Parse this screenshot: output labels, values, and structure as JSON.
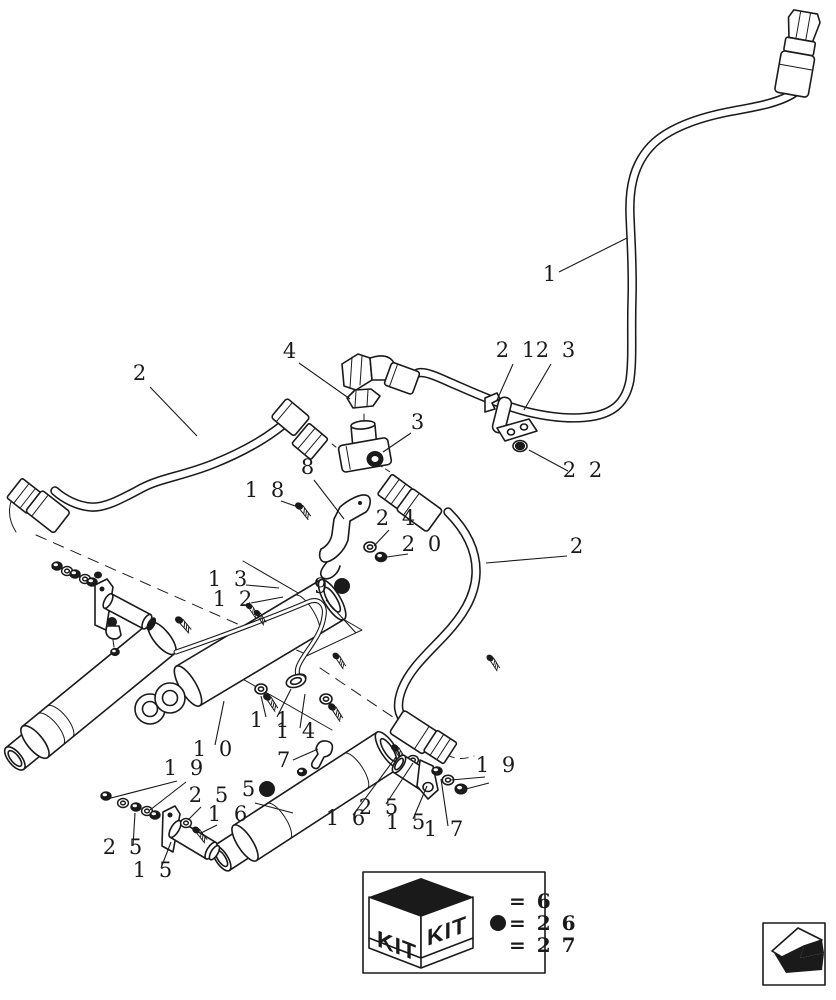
{
  "page": {
    "background": "#ffffff",
    "ink": "#1a1a1a",
    "figure": "exploded-parts-diagram"
  },
  "callouts": [
    {
      "id": "1",
      "text": "1",
      "x": 551,
      "y": 281,
      "leaders": [
        [
          559,
          272,
          627,
          238
        ]
      ]
    },
    {
      "id": "2-left-hose",
      "text": "2",
      "x": 141,
      "y": 380,
      "leaders": [
        [
          150,
          387,
          197,
          436
        ]
      ]
    },
    {
      "id": "4",
      "text": "4",
      "x": 291,
      "y": 358,
      "leaders": [
        [
          299,
          363,
          350,
          399
        ]
      ]
    },
    {
      "id": "21",
      "text": "2 1",
      "x": 517,
      "y": 357,
      "leaders": [
        [
          513,
          364,
          497,
          400
        ]
      ]
    },
    {
      "id": "23",
      "text": "2 3",
      "x": 557,
      "y": 357,
      "leaders": [
        [
          551,
          364,
          524,
          410
        ]
      ]
    },
    {
      "id": "3",
      "text": "3",
      "x": 419,
      "y": 429,
      "leaders": [
        [
          411,
          433,
          383,
          452
        ]
      ]
    },
    {
      "id": "22",
      "text": "2 2",
      "x": 584,
      "y": 477,
      "leaders": [
        [
          568,
          471,
          529,
          450
        ]
      ]
    },
    {
      "id": "8",
      "text": "8",
      "x": 309,
      "y": 474,
      "leaders": [
        [
          314,
          480,
          344,
          519
        ]
      ]
    },
    {
      "id": "18",
      "text": "1 8",
      "x": 266,
      "y": 497,
      "leaders": [
        [
          281,
          501,
          301,
          508
        ]
      ]
    },
    {
      "id": "24",
      "text": "2 4",
      "x": 397,
      "y": 525,
      "leaders": [
        [
          389,
          530,
          374,
          546
        ]
      ]
    },
    {
      "id": "20",
      "text": "2 0",
      "x": 423,
      "y": 551,
      "leaders": [
        [
          408,
          554,
          387,
          557
        ]
      ]
    },
    {
      "id": "2-right-hose",
      "text": "2",
      "x": 578,
      "y": 553,
      "leaders": [
        [
          567,
          556,
          486,
          563
        ]
      ]
    },
    {
      "id": "13",
      "text": "1 3",
      "x": 229,
      "y": 586,
      "leaders": [
        [
          246,
          585,
          279,
          588
        ]
      ]
    },
    {
      "id": "12",
      "text": "1 2",
      "x": 234,
      "y": 606,
      "leaders": [
        [
          251,
          603,
          283,
          597
        ]
      ]
    },
    {
      "id": "9",
      "text": "9",
      "x": 322,
      "y": 593,
      "bullet": [
        342,
        586
      ],
      "leaders": [
        [
          326,
          600,
          356,
          633
        ]
      ]
    },
    {
      "id": "10",
      "text": "1 0",
      "x": 214,
      "y": 756,
      "leaders": [
        [
          215,
          745,
          224,
          701
        ]
      ]
    },
    {
      "id": "11",
      "text": "1 1",
      "x": 271,
      "y": 727,
      "leaders": [
        [
          266,
          717,
          261,
          696
        ],
        [
          277,
          717,
          291,
          689
        ]
      ]
    },
    {
      "id": "14",
      "text": "1 4",
      "x": 297,
      "y": 738,
      "leaders": [
        [
          300,
          728,
          305,
          694
        ]
      ]
    },
    {
      "id": "7",
      "text": "7",
      "x": 285,
      "y": 767,
      "leaders": [
        [
          293,
          760,
          318,
          749
        ]
      ]
    },
    {
      "id": "19-left",
      "text": "1 9",
      "x": 185,
      "y": 775,
      "leaders": [
        [
          177,
          781,
          111,
          798
        ],
        [
          186,
          782,
          150,
          810
        ]
      ]
    },
    {
      "id": "25-upper-left",
      "text": "2 5",
      "x": 210,
      "y": 802,
      "leaders": [
        [
          201,
          807,
          188,
          820
        ]
      ]
    },
    {
      "id": "5",
      "text": "5",
      "x": 250,
      "y": 796,
      "bullet": [
        267,
        789
      ],
      "leaders": [
        [
          255,
          803,
          293,
          813
        ]
      ]
    },
    {
      "id": "16-left",
      "text": "1 6",
      "x": 229,
      "y": 821,
      "leaders": [
        [
          217,
          825,
          201,
          833
        ]
      ]
    },
    {
      "id": "25-lower-left",
      "text": "2 5",
      "x": 124,
      "y": 854,
      "leaders": [
        [
          133,
          846,
          135,
          813
        ]
      ]
    },
    {
      "id": "15-left",
      "text": "1 5",
      "x": 154,
      "y": 877,
      "leaders": [
        [
          161,
          868,
          171,
          842
        ]
      ]
    },
    {
      "id": "16-right",
      "text": "1 6",
      "x": 347,
      "y": 825,
      "leaders": [
        [
          353,
          815,
          396,
          757
        ]
      ]
    },
    {
      "id": "25-right",
      "text": "2 5",
      "x": 380,
      "y": 814,
      "leaders": [
        [
          386,
          804,
          413,
          763
        ]
      ]
    },
    {
      "id": "15-right",
      "text": "1 5",
      "x": 407,
      "y": 829,
      "leaders": [
        [
          413,
          819,
          427,
          786
        ]
      ]
    },
    {
      "id": "17",
      "text": "1 7",
      "x": 445,
      "y": 836,
      "leaders": [
        [
          448,
          826,
          441,
          779
        ]
      ]
    },
    {
      "id": "19-right",
      "text": "1 9",
      "x": 497,
      "y": 772,
      "leaders": [
        [
          485,
          777,
          451,
          780
        ],
        [
          489,
          783,
          462,
          790
        ]
      ]
    }
  ],
  "kit_box": {
    "label": "KIT",
    "legend": [
      {
        "bullet": false,
        "text": "= 6"
      },
      {
        "bullet": true,
        "text": "= 2 6"
      },
      {
        "bullet": false,
        "text": "= 2 7"
      }
    ]
  },
  "icons": {
    "kit_bullet": "filled-circle",
    "nav_arrow": "back-arrow-3d"
  }
}
